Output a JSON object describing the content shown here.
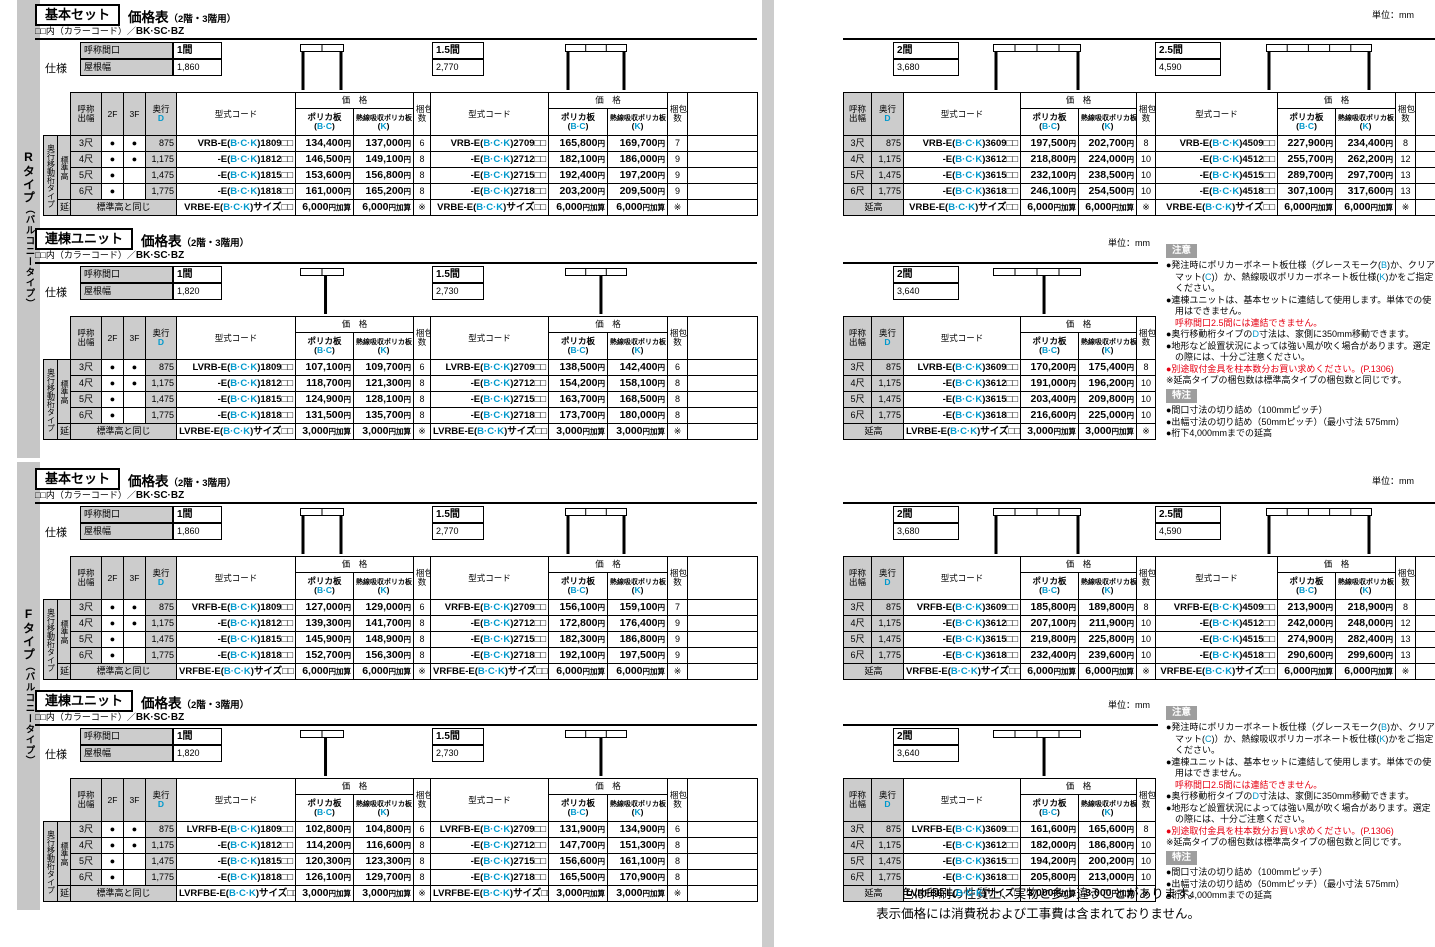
{
  "page": {
    "unit": "単位：mm",
    "ccode_prefix": "□□内（カラーコード）／",
    "ccode_value": "BK·SC·BZ"
  },
  "sidebar": {
    "r_type": "Rタイプ",
    "f_type": "Fタイプ",
    "suffix": "（バルコニータイプ）"
  },
  "labels": {
    "spec": "仕様",
    "span": "呼称間口",
    "roof": "屋根幅",
    "col_width": "呼称出幅",
    "col_2f": "2F",
    "col_3f": "3F",
    "col_depth": "奥行",
    "col_depth_letter": "D",
    "col_model": "型式コード",
    "col_price": "価　格",
    "col_poly1": "ポリカ板",
    "col_poly2": "(B·C)",
    "col_heat1": "熱線吸収ポリカ板",
    "col_heat2": "(K)",
    "col_pack": "梱包数",
    "row_type": "奥行移動桁タイプ",
    "std_height": "標準高",
    "ext_height": "延高",
    "same_as_std": "標準高と同じ"
  },
  "notes": {
    "caution_title": "注意",
    "caution_items": [
      {
        "text": "●発注時にポリカーボネート板仕様（グレースモーク(B)か、クリアマット(C)）か、熱線吸収ポリカーボネート板仕様(K)かをご指定ください。"
      },
      {
        "text": "●連棟ユニットは、基本セットに連結して使用します。単体での使用はできません。"
      },
      {
        "text": "呼称間口2.5間には連結できません。",
        "red": true,
        "indent": true
      },
      {
        "text": "●奥行移動桁タイプのD寸法は、家側に350mm移動できます。"
      },
      {
        "text": "●地形など設置状況によっては強い風が吹く場合があります。選定の際には、十分ご注意ください。"
      },
      {
        "text": "●別途取付金具を柱本数分お買い求めください。(P.1306)",
        "red": true
      },
      {
        "text": "※延高タイプの梱包数は標準高タイプの梱包数と同じです。"
      }
    ],
    "special_title": "特注",
    "special_items": [
      {
        "text": "●間口寸法の切り詰め（100mmピッチ）"
      },
      {
        "text": "●出幅寸法の切り詰め（50mmピッチ）（最小寸法 575mm）"
      },
      {
        "text": "●桁下4,000mmまでの延高"
      }
    ]
  },
  "footer": {
    "line1": "商品の色は印刷の性質上、実物と多少違うことがあります。",
    "line2": "表示価格には消費税および工事費は含まれておりません。"
  },
  "sections": [
    {
      "name": "r-basic-set",
      "badge": "基本セット",
      "title": "価格表",
      "title_note": "（2階・3階用）",
      "spec_rows": [
        [
          "3尺",
          "●",
          "●",
          "875"
        ],
        [
          "4尺",
          "●",
          "●",
          "1,175"
        ],
        [
          "5尺",
          "●",
          "",
          "1,475"
        ],
        [
          "6尺",
          "●",
          "",
          "1,775"
        ]
      ],
      "groups": [
        {
          "span": "1間",
          "roof": "1,860",
          "models": [
            "VRB-E(B·C·K)1809□□",
            "-E(B·C·K)1812□□",
            "-E(B·C·K)1815□□",
            "-E(B·C·K)1818□□"
          ],
          "price_bc": [
            "134,400円",
            "146,500円",
            "153,600円",
            "161,000円"
          ],
          "price_k": [
            "137,000円",
            "149,100円",
            "156,800円",
            "165,200円"
          ],
          "packs": [
            "6",
            "8",
            "8",
            "8"
          ],
          "ext_model": "VRBE-E(B·C·K)サイズ□□",
          "ext_price": "6,000円加算",
          "ext_pack": "※"
        },
        {
          "span": "1.5間",
          "roof": "2,770",
          "models": [
            "VRB-E(B·C·K)2709□□",
            "-E(B·C·K)2712□□",
            "-E(B·C·K)2715□□",
            "-E(B·C·K)2718□□"
          ],
          "price_bc": [
            "165,800円",
            "182,100円",
            "192,400円",
            "203,200円"
          ],
          "price_k": [
            "169,700円",
            "186,000円",
            "197,200円",
            "209,500円"
          ],
          "packs": [
            "7",
            "9",
            "9",
            "9"
          ],
          "ext_model": "VRBE-E(B·C·K)サイズ□□",
          "ext_price": "6,000円加算",
          "ext_pack": "※"
        },
        {
          "span": "2間",
          "roof": "3,680",
          "models": [
            "VRB-E(B·C·K)3609□□",
            "-E(B·C·K)3612□□",
            "-E(B·C·K)3615□□",
            "-E(B·C·K)3618□□"
          ],
          "price_bc": [
            "197,500円",
            "218,800円",
            "232,100円",
            "246,100円"
          ],
          "price_k": [
            "202,700円",
            "224,000円",
            "238,500円",
            "254,500円"
          ],
          "packs": [
            "8",
            "10",
            "10",
            "10"
          ],
          "ext_model": "VRBE-E(B·C·K)サイズ□□",
          "ext_price": "6,000円加算",
          "ext_pack": "※"
        },
        {
          "span": "2.5間",
          "roof": "4,590",
          "models": [
            "VRB-E(B·C·K)4509□□",
            "-E(B·C·K)4512□□",
            "-E(B·C·K)4515□□",
            "-E(B·C·K)4518□□"
          ],
          "price_bc": [
            "227,900円",
            "255,700円",
            "289,700円",
            "307,100円"
          ],
          "price_k": [
            "234,400円",
            "262,200円",
            "297,700円",
            "317,600円"
          ],
          "packs": [
            "8",
            "12",
            "13",
            "13"
          ],
          "ext_model": "VRBE-E(B·C·K)サイズ□□",
          "ext_price": "6,000円加算",
          "ext_pack": "※"
        }
      ]
    },
    {
      "name": "r-rento-unit",
      "badge": "連棟ユニット",
      "title": "価格表",
      "title_note": "（2階・3階用）",
      "spec_rows": [
        [
          "3尺",
          "●",
          "●",
          "875"
        ],
        [
          "4尺",
          "●",
          "●",
          "1,175"
        ],
        [
          "5尺",
          "●",
          "",
          "1,475"
        ],
        [
          "6尺",
          "●",
          "",
          "1,775"
        ]
      ],
      "groups": [
        {
          "span": "1間",
          "roof": "1,820",
          "models": [
            "LVRB-E(B·C·K)1809□□",
            "-E(B·C·K)1812□□",
            "-E(B·C·K)1815□□",
            "-E(B·C·K)1818□□"
          ],
          "price_bc": [
            "107,100円",
            "118,700円",
            "124,900円",
            "131,500円"
          ],
          "price_k": [
            "109,700円",
            "121,300円",
            "128,100円",
            "135,700円"
          ],
          "packs": [
            "6",
            "8",
            "8",
            "8"
          ],
          "ext_model": "LVRBE-E(B·C·K)サイズ□□",
          "ext_price": "3,000円加算",
          "ext_pack": "※"
        },
        {
          "span": "1.5間",
          "roof": "2,730",
          "models": [
            "LVRB-E(B·C·K)2709□□",
            "-E(B·C·K)2712□□",
            "-E(B·C·K)2715□□",
            "-E(B·C·K)2718□□"
          ],
          "price_bc": [
            "138,500円",
            "154,200円",
            "163,700円",
            "173,700円"
          ],
          "price_k": [
            "142,400円",
            "158,100円",
            "168,500円",
            "180,000円"
          ],
          "packs": [
            "6",
            "8",
            "8",
            "8"
          ],
          "ext_model": "LVRBE-E(B·C·K)サイズ□□",
          "ext_price": "3,000円加算",
          "ext_pack": "※"
        },
        {
          "span": "2間",
          "roof": "3,640",
          "models": [
            "LVRB-E(B·C·K)3609□□",
            "-E(B·C·K)3612□□",
            "-E(B·C·K)3615□□",
            "-E(B·C·K)3618□□"
          ],
          "price_bc": [
            "170,200円",
            "191,000円",
            "203,400円",
            "216,600円"
          ],
          "price_k": [
            "175,400円",
            "196,200円",
            "209,800円",
            "225,000円"
          ],
          "packs": [
            "8",
            "10",
            "10",
            "10"
          ],
          "ext_model": "LVRBE-E(B·C·K)サイズ□□",
          "ext_price": "3,000円加算",
          "ext_pack": "※"
        }
      ]
    },
    {
      "name": "f-basic-set",
      "badge": "基本セット",
      "title": "価格表",
      "title_note": "（2階・3階用）",
      "spec_rows": [
        [
          "3尺",
          "●",
          "●",
          "875"
        ],
        [
          "4尺",
          "●",
          "●",
          "1,175"
        ],
        [
          "5尺",
          "●",
          "",
          "1,475"
        ],
        [
          "6尺",
          "●",
          "",
          "1,775"
        ]
      ],
      "groups": [
        {
          "span": "1間",
          "roof": "1,860",
          "models": [
            "VRFB-E(B·C·K)1809□□",
            "-E(B·C·K)1812□□",
            "-E(B·C·K)1815□□",
            "-E(B·C·K)1818□□"
          ],
          "price_bc": [
            "127,000円",
            "139,300円",
            "145,900円",
            "152,700円"
          ],
          "price_k": [
            "129,000円",
            "141,700円",
            "148,900円",
            "156,300円"
          ],
          "packs": [
            "6",
            "8",
            "8",
            "8"
          ],
          "ext_model": "VRFBE-E(B·C·K)サイズ□□",
          "ext_price": "6,000円加算",
          "ext_pack": "※"
        },
        {
          "span": "1.5間",
          "roof": "2,770",
          "models": [
            "VRFB-E(B·C·K)2709□□",
            "-E(B·C·K)2712□□",
            "-E(B·C·K)2715□□",
            "-E(B·C·K)2718□□"
          ],
          "price_bc": [
            "156,100円",
            "172,800円",
            "182,300円",
            "192,100円"
          ],
          "price_k": [
            "159,100円",
            "176,400円",
            "186,800円",
            "197,500円"
          ],
          "packs": [
            "7",
            "9",
            "9",
            "9"
          ],
          "ext_model": "VRFBE-E(B·C·K)サイズ□□",
          "ext_price": "6,000円加算",
          "ext_pack": "※"
        },
        {
          "span": "2間",
          "roof": "3,680",
          "models": [
            "VRFB-E(B·C·K)3609□□",
            "-E(B·C·K)3612□□",
            "-E(B·C·K)3615□□",
            "-E(B·C·K)3618□□"
          ],
          "price_bc": [
            "185,800円",
            "207,100円",
            "219,800円",
            "232,400円"
          ],
          "price_k": [
            "189,800円",
            "211,900円",
            "225,800円",
            "239,600円"
          ],
          "packs": [
            "8",
            "10",
            "10",
            "10"
          ],
          "ext_model": "VRFBE-E(B·C·K)サイズ□□",
          "ext_price": "6,000円加算",
          "ext_pack": "※"
        },
        {
          "span": "2.5間",
          "roof": "4,590",
          "models": [
            "VRFB-E(B·C·K)4509□□",
            "-E(B·C·K)4512□□",
            "-E(B·C·K)4515□□",
            "-E(B·C·K)4518□□"
          ],
          "price_bc": [
            "213,900円",
            "242,000円",
            "274,900円",
            "290,600円"
          ],
          "price_k": [
            "218,900円",
            "248,000円",
            "282,400円",
            "299,600円"
          ],
          "packs": [
            "8",
            "12",
            "13",
            "13"
          ],
          "ext_model": "VRFBE-E(B·C·K)サイズ□□",
          "ext_price": "6,000円加算",
          "ext_pack": "※"
        }
      ]
    },
    {
      "name": "f-rento-unit",
      "badge": "連棟ユニット",
      "title": "価格表",
      "title_note": "（2階・3階用）",
      "spec_rows": [
        [
          "3尺",
          "●",
          "●",
          "875"
        ],
        [
          "4尺",
          "●",
          "●",
          "1,175"
        ],
        [
          "5尺",
          "●",
          "",
          "1,475"
        ],
        [
          "6尺",
          "●",
          "",
          "1,775"
        ]
      ],
      "groups": [
        {
          "span": "1間",
          "roof": "1,820",
          "models": [
            "LVRFB-E(B·C·K)1809□□",
            "-E(B·C·K)1812□□",
            "-E(B·C·K)1815□□",
            "-E(B·C·K)1818□□"
          ],
          "price_bc": [
            "102,800円",
            "114,200円",
            "120,300円",
            "126,100円"
          ],
          "price_k": [
            "104,800円",
            "116,600円",
            "123,300円",
            "129,700円"
          ],
          "packs": [
            "6",
            "8",
            "8",
            "8"
          ],
          "ext_model": "LVRFBE-E(B·C·K)サイズ□□",
          "ext_price": "3,000円加算",
          "ext_pack": "※"
        },
        {
          "span": "1.5間",
          "roof": "2,730",
          "models": [
            "LVRFB-E(B·C·K)2709□□",
            "-E(B·C·K)2712□□",
            "-E(B·C·K)2715□□",
            "-E(B·C·K)2718□□"
          ],
          "price_bc": [
            "131,900円",
            "147,700円",
            "156,600円",
            "165,500円"
          ],
          "price_k": [
            "134,900円",
            "151,300円",
            "161,100円",
            "170,900円"
          ],
          "packs": [
            "6",
            "8",
            "8",
            "8"
          ],
          "ext_model": "LVRFBE-E(B·C·K)サイズ□□",
          "ext_price": "3,000円加算",
          "ext_pack": "※"
        },
        {
          "span": "2間",
          "roof": "3,640",
          "models": [
            "LVRFB-E(B·C·K)3609□□",
            "-E(B·C·K)3612□□",
            "-E(B·C·K)3615□□",
            "-E(B·C·K)3618□□"
          ],
          "price_bc": [
            "161,600円",
            "182,000円",
            "194,200円",
            "205,800円"
          ],
          "price_k": [
            "165,600円",
            "186,800円",
            "200,200円",
            "213,000円"
          ],
          "packs": [
            "8",
            "10",
            "10",
            "10"
          ],
          "ext_model": "LVRFBE-E(B·C·K)サイズ□□",
          "ext_price": "3,000円加算",
          "ext_pack": "※"
        }
      ]
    }
  ]
}
